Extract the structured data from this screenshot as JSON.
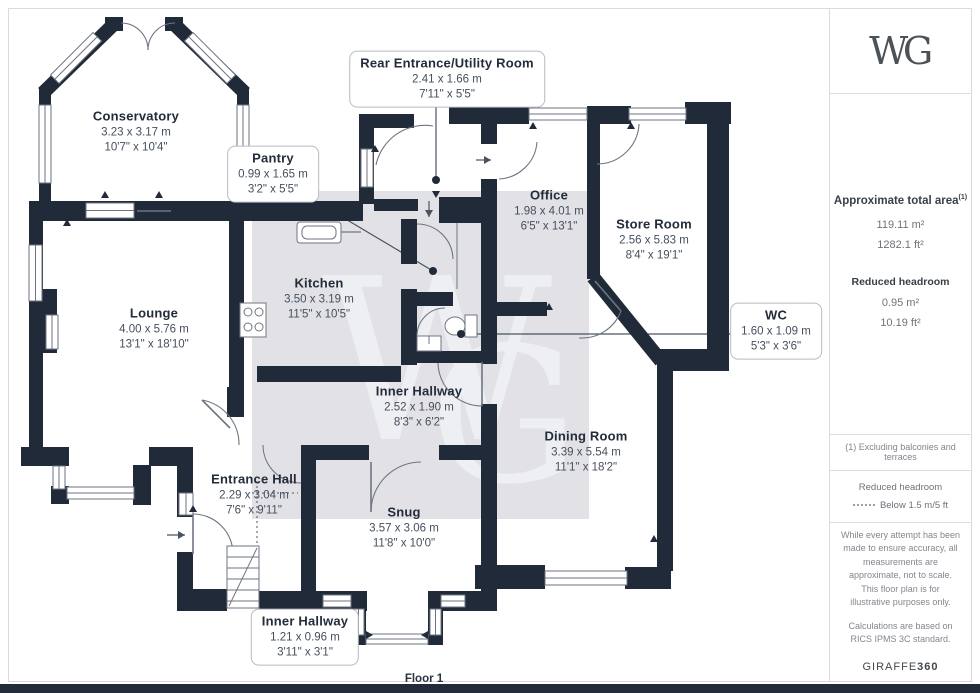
{
  "plan": {
    "floor_label": "Floor 1",
    "watermark": "WG",
    "rooms": [
      {
        "id": "conservatory",
        "name": "Conservatory",
        "metric": "3.23 x 3.17 m",
        "imperial": "10'7\" x 10'4\"",
        "style": "plain"
      },
      {
        "id": "rear-entrance",
        "name": "Rear Entrance/Utility Room",
        "metric": "2.41 x 1.66 m",
        "imperial": "7'11\" x 5'5\"",
        "style": "callout"
      },
      {
        "id": "pantry",
        "name": "Pantry",
        "metric": "0.99 x 1.65 m",
        "imperial": "3'2\" x 5'5\"",
        "style": "callout"
      },
      {
        "id": "office",
        "name": "Office",
        "metric": "1.98 x 4.01 m",
        "imperial": "6'5\" x 13'1\"",
        "style": "plain"
      },
      {
        "id": "store-room",
        "name": "Store Room",
        "metric": "2.56 x 5.83 m",
        "imperial": "8'4\" x 19'1\"",
        "style": "plain"
      },
      {
        "id": "kitchen",
        "name": "Kitchen",
        "metric": "3.50 x 3.19 m",
        "imperial": "11'5\" x 10'5\"",
        "style": "plain"
      },
      {
        "id": "lounge",
        "name": "Lounge",
        "metric": "4.00 x 5.76 m",
        "imperial": "13'1\" x 18'10\"",
        "style": "plain"
      },
      {
        "id": "wc",
        "name": "WC",
        "metric": "1.60 x 1.09 m",
        "imperial": "5'3\" x 3'6\"",
        "style": "callout"
      },
      {
        "id": "inner-hallway",
        "name": "Inner Hallway",
        "metric": "2.52 x 1.90 m",
        "imperial": "8'3\" x 6'2\"",
        "style": "plain"
      },
      {
        "id": "dining-room",
        "name": "Dining Room",
        "metric": "3.39 x 5.54 m",
        "imperial": "11'1\" x 18'2\"",
        "style": "plain"
      },
      {
        "id": "entrance-hall",
        "name": "Entrance Hall",
        "metric": "2.29 x 3.04 m",
        "imperial": "7'6\" x 9'11\"",
        "style": "plain"
      },
      {
        "id": "snug",
        "name": "Snug",
        "metric": "3.57 x 3.06 m",
        "imperial": "11'8\" x 10'0\"",
        "style": "plain"
      },
      {
        "id": "inner-hallway-2",
        "name": "Inner Hallway",
        "metric": "1.21 x 0.96 m",
        "imperial": "3'11\" x 3'1\"",
        "style": "callout"
      }
    ]
  },
  "sidebar": {
    "logo": "WG",
    "area": {
      "heading": "Approximate total area",
      "footnote_ref": "(1)",
      "metric": "119.11 m²",
      "imperial": "1282.1 ft²"
    },
    "reduced_headroom": {
      "heading": "Reduced headroom",
      "metric": "0.95 m²",
      "imperial": "10.19 ft²"
    },
    "footnote": "(1) Excluding balconies and terraces",
    "legend": {
      "heading": "Reduced headroom",
      "item": "Below 1.5 m/5 ft"
    },
    "disclaimer": "While every attempt has been made to ensure accuracy, all measurements are approximate, not to scale. This floor plan is for illustrative purposes only.",
    "standard": "Calculations are based on RICS IPMS 3C standard.",
    "brand": {
      "name": "GIRAFFE",
      "suffix": "360"
    }
  },
  "colors": {
    "wall": "#212a38",
    "highlight": "#e2e2e6",
    "watermark": "#edeff2",
    "line": "#6e7582",
    "leader": "#4a5360",
    "label_title": "#232c3a",
    "label_dims": "#454f5e",
    "bottom_bar": "#222b39"
  }
}
